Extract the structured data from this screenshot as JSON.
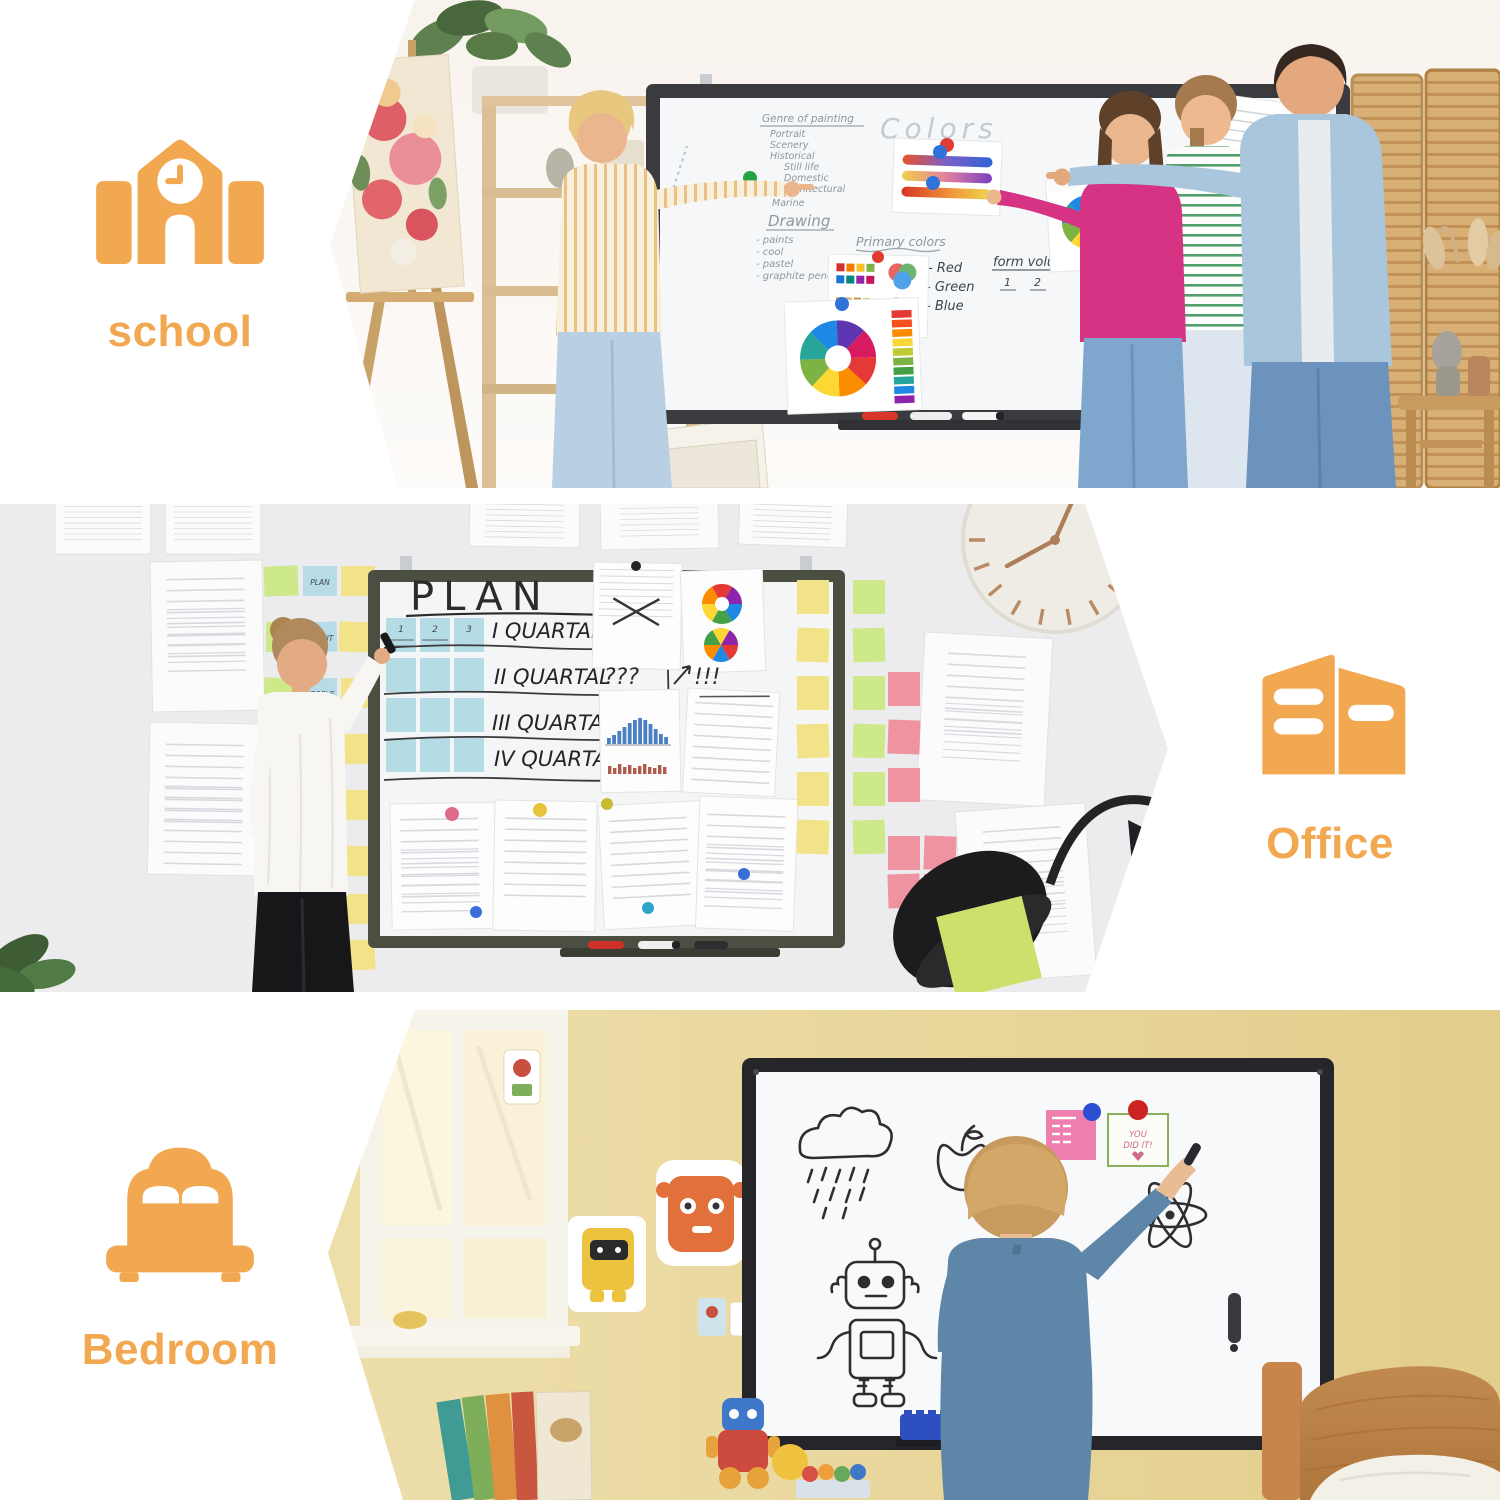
{
  "page": {
    "background": "#ffffff",
    "accent_color": "#F2A851"
  },
  "sections": {
    "school": {
      "label": "school",
      "icon": "school-building-icon",
      "board": {
        "title": "Colors",
        "genre_heading": "Genre of painting",
        "genre_items": [
          "Portrait",
          "Scenery",
          "Historical",
          "Still life",
          "Domestic",
          "Architectural",
          "Marine"
        ],
        "drawing_heading": "Drawing",
        "drawing_items": [
          "- paints",
          "- cool",
          "- pastel",
          "- graphite pencil"
        ],
        "primary_heading": "Primary colors",
        "primary_items": [
          "- Red",
          "- Green",
          "- Blue"
        ],
        "form_heading": "form volume",
        "form_num1": "1",
        "form_num2": "2"
      }
    },
    "office": {
      "label": "Office",
      "icon": "office-building-icon",
      "board": {
        "title": "PLAN",
        "rows": [
          "I QUARTAL",
          "II QUARTAL",
          "III QUARTAL",
          "IV QUARTAL"
        ],
        "grid_numbers": [
          "1",
          "2",
          "3"
        ],
        "question_marks": "???",
        "exclamation_marks": "!!!"
      },
      "sticky_notes": [
        "PLAN",
        "PROFIT",
        "PEOPLE",
        "LIFE",
        "BALANCE",
        "WEB",
        "DESIGN",
        "PROJECT",
        "STRATEGY",
        "??"
      ]
    },
    "bedroom": {
      "label": "Bedroom",
      "icon": "bed-icon",
      "board": {
        "letters": "ABC",
        "note_line1": "YOU",
        "note_line2": "DID IT!"
      }
    }
  }
}
